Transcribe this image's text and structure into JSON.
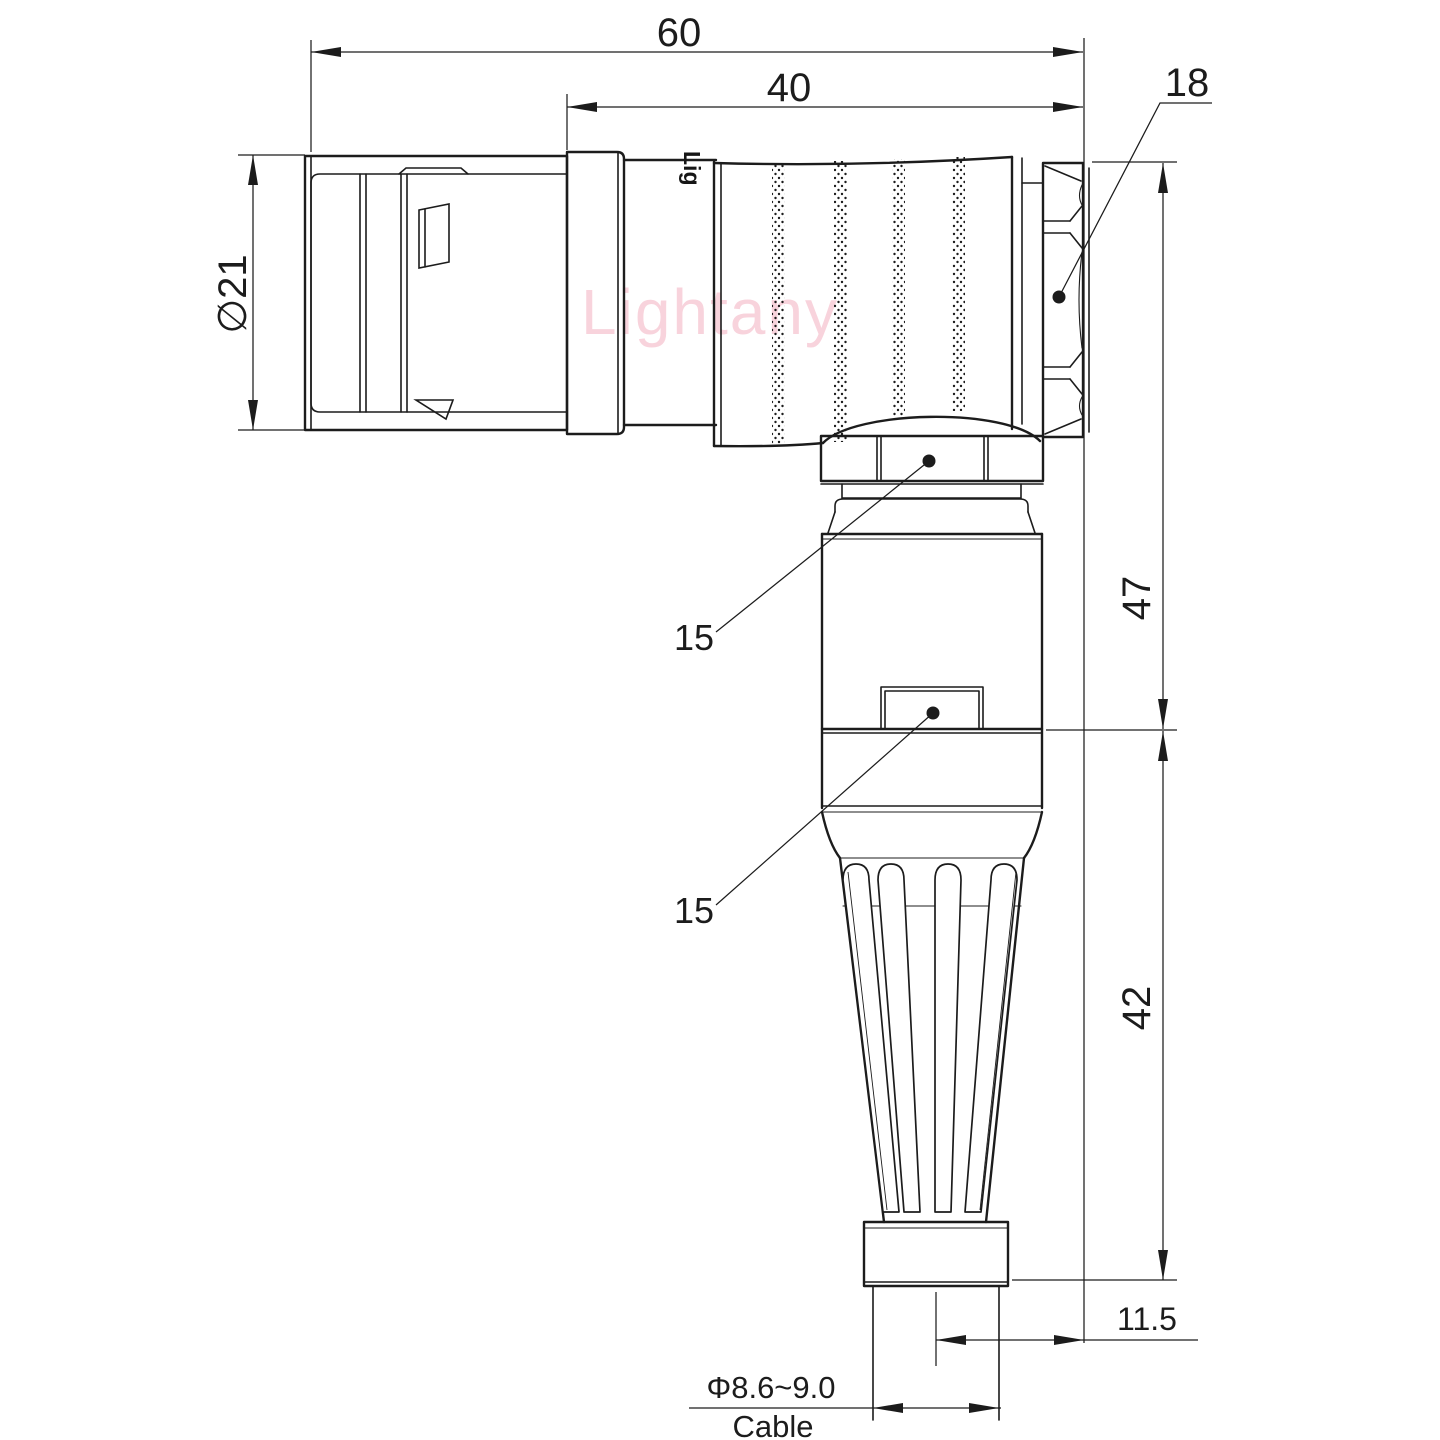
{
  "drawing": {
    "kind": "connector-dimension-drawing",
    "watermark": "Lightany",
    "body_print": "Lig",
    "labels": {
      "dim_overall_length": "60",
      "dim_rear_length": "40",
      "dim_nut": "18",
      "dim_front_diameter": "∅21",
      "dim_height_upper": "47",
      "dim_height_lower": "42",
      "dim_offset": "11.5",
      "dim_cable_diameter": "Φ8.6~9.0",
      "dim_cable_caption": "Cable",
      "callout_gland_nut": "15",
      "callout_body_window": "15"
    },
    "colors": {
      "line": "#1c1c1c",
      "watermark": "#f4b7c5",
      "background": "#ffffff"
    }
  }
}
